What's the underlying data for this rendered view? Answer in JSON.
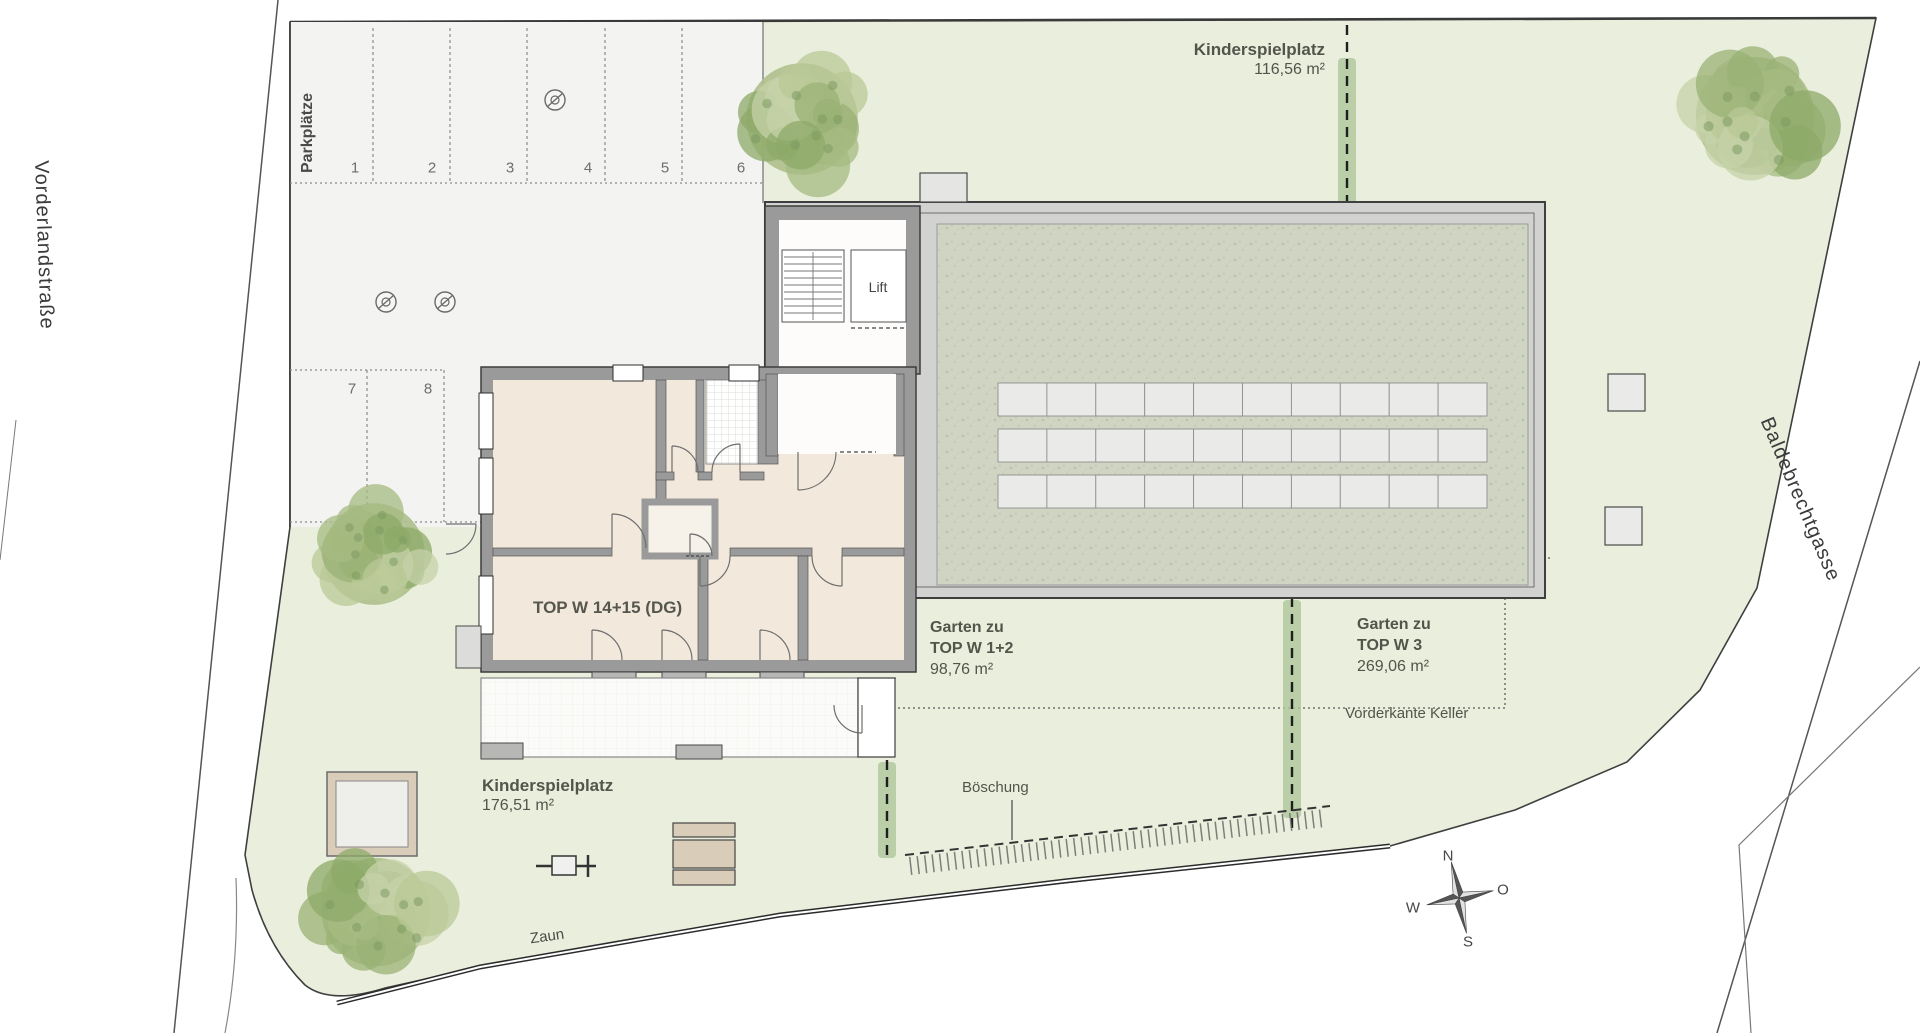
{
  "streets": {
    "left_label": "Vorderlandstraße",
    "right_label": "Baldebrechtgasse"
  },
  "parking": {
    "label": "Parkplätze",
    "space_numbers": [
      "1",
      "2",
      "3",
      "4",
      "5",
      "6",
      "7",
      "8"
    ]
  },
  "building": {
    "unit_label": "TOP W 14+15 (DG)",
    "lift_label": "Lift"
  },
  "areas": {
    "playground_north": {
      "name": "Kinderspielplatz",
      "area": "116,56 m²"
    },
    "playground_south": {
      "name": "Kinderspielplatz",
      "area": "176,51 m²"
    },
    "garden_top_w12": {
      "prefix": "Garten zu",
      "unit": "TOP W 1+2",
      "area": "98,76 m²"
    },
    "garden_top_w3": {
      "prefix": "Garten zu",
      "unit": "TOP W 3",
      "area": "269,06 m²"
    }
  },
  "annotations": {
    "cellar_front_edge": "Vorderkante Keller",
    "embankment": "Böschung",
    "fence": "Zaun"
  },
  "compass": {
    "n": "N",
    "e": "O",
    "s": "S",
    "w": "W"
  },
  "colors": {
    "site_green": "#e9efdc",
    "parking_gray": "#f3f3f1",
    "wall_gray": "#9a9a9a",
    "terrace_speckle": "#cfd4c3",
    "room_cream": "#f2e9dc",
    "hedge_green": "#aec69b",
    "tree_green": "#aebf8c",
    "sand_tan": "#d9cdb9"
  }
}
